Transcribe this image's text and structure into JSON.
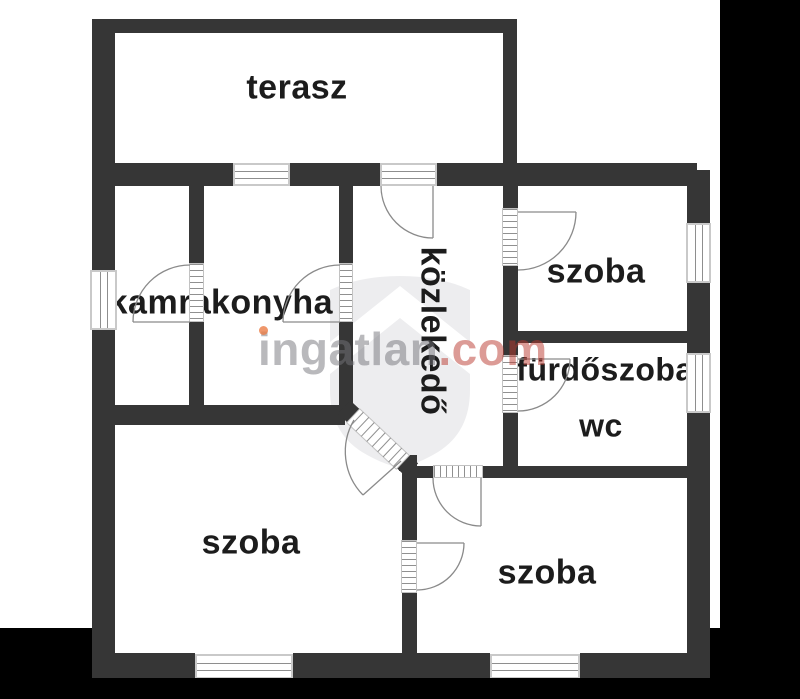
{
  "watermark": {
    "brand": "ingatlan",
    "brand_suffix": ".com"
  },
  "rooms": {
    "terasz": "terasz",
    "kamra": "kamra",
    "konyha": "konyha",
    "kozlekedo": "közlekedő",
    "szoba_top_right": "szoba",
    "furdoszoba": "fürdőszoba",
    "wc": "wc",
    "szoba_bottom_left": "szoba",
    "szoba_bottom_right": "szoba"
  },
  "colors": {
    "wall": "#363636",
    "floor": "#ffffff",
    "outside": "#000000",
    "window_frame": "#c9c9c9",
    "symbol_line": "#8e8e8e",
    "label_text": "#1c1c1c",
    "watermark_gray": "#73737a",
    "watermark_accent": "#b9372d",
    "watermark_dot": "#eb7d46",
    "shield": "#ededef"
  }
}
